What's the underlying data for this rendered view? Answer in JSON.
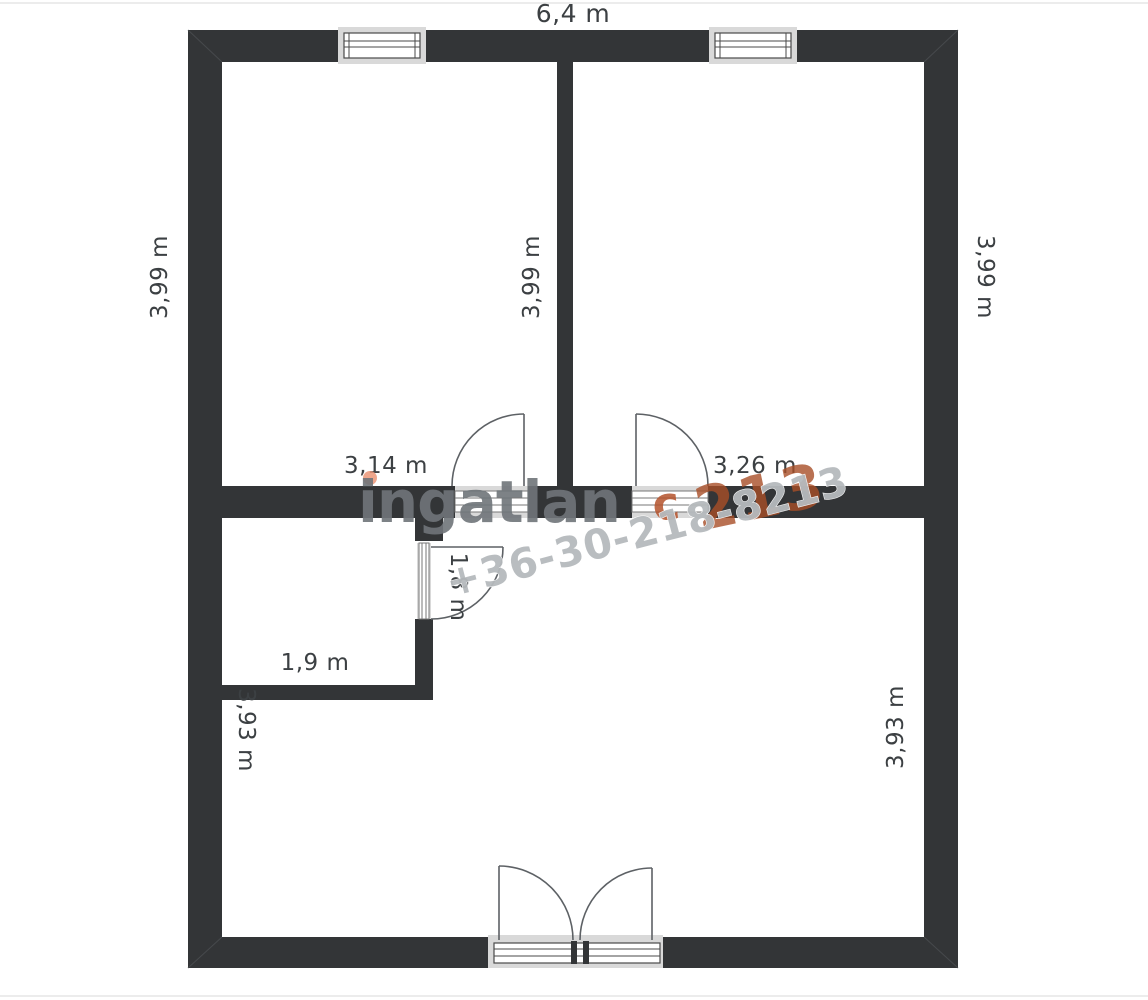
{
  "title": "floor-plan",
  "colors": {
    "wall": "#333537",
    "frame_light": "#d9d9d9",
    "door_line": "#5d6165",
    "label_text": "#3c4043",
    "watermark_gray": "#70757a",
    "watermark_phone_gray": "#b6babd",
    "watermark_orange": "#b5532c",
    "watermark_salmon": "#eb9678"
  },
  "labels": {
    "top_width": "6,4 m",
    "bottom_width": "6,4 m",
    "left_height": "3,99 m",
    "middle_height": "3,99 m",
    "right_height": "3,99 m",
    "room_left_width": "3,14 m",
    "room_right_width": "3,26 m",
    "closet_door_width": "1,8 m",
    "closet_width": "1,9 m",
    "hall_left_height": "3,93 m",
    "hall_right_height": "3,93 m"
  },
  "watermark": {
    "logo_text": "ingatlan",
    "logo_c": "c",
    "digits_fragment": "213",
    "phone": "+36-30-218-8213"
  }
}
